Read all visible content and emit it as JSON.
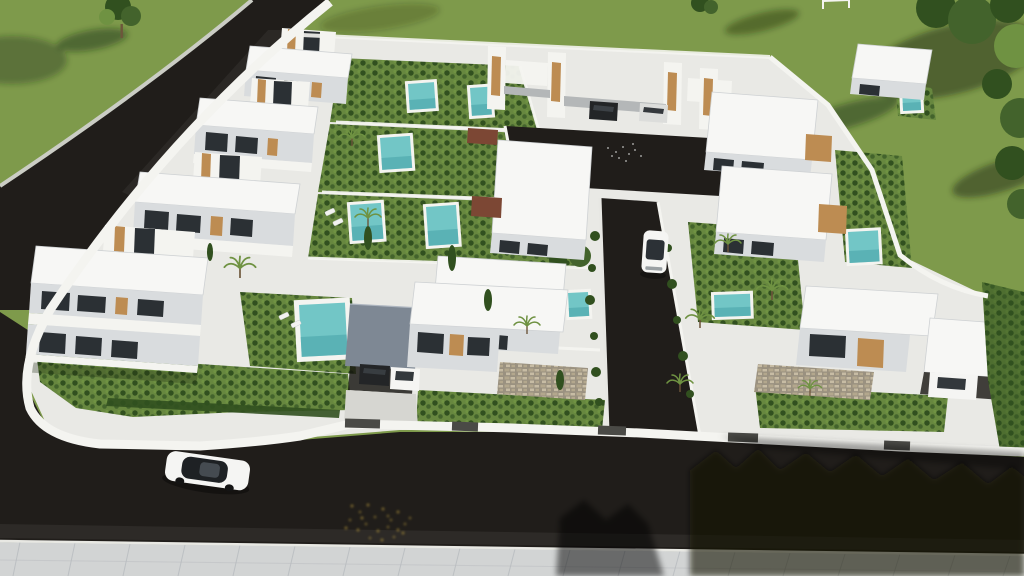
{
  "meta": {
    "type": "aerial-3d-architectural-render",
    "subject": "Aerial 3D rendering of a modern white villa development with private pools, asphalt streets, landscaped gardens and lawns",
    "no_visible_text": true
  },
  "palette": {
    "grass": "#7e9a4b",
    "lawn_shadow": "#1d2a10",
    "road": "#201d1a",
    "pavement": "#d2d4d4",
    "pavement_line": "#b9bcc0",
    "concrete": "#e9e9e5",
    "wall": "#f4f4f0",
    "face": "#d9dcde",
    "roof": "#f7f7f5",
    "roof_edge": "#ced1d3",
    "roof_gray": "#7e8894",
    "wood": "#bd8c52",
    "terracotta": "#7c4734",
    "glass": "#2b3034",
    "pool": "#72c6c6",
    "pool_deep": "#47a2a7",
    "garden": "#67873f",
    "tree_dark": "#31501f",
    "shrub": "#43632c",
    "palm_green": "#6f9242",
    "trunk": "#6d563b",
    "car_white": "#f5f5f3",
    "car_silver": "#dcdddb",
    "car_dark": "#232527",
    "gold": "#bd9d3e",
    "gate": "#4a4a46",
    "stone_bg": "#9a9180",
    "stone_a": "#b3a78d",
    "stone_b": "#c7bca4"
  },
  "scene": {
    "lawns": [
      "upper-left lawn with single tree",
      "large upper-right lawn with tree cluster and long shadows"
    ],
    "streets": {
      "left_street": "diagonal asphalt road along upper-left edge",
      "front_street": "wide asphalt road along the bottom",
      "sidewalk": "light paved sidewalk along bottom edge",
      "internal_driveway": "private lane from central courtyard to front street"
    },
    "block": {
      "villas": 11,
      "carport_duplex_units": 2,
      "pools": 10,
      "boundary": "white perimeter wall with dark gate segments",
      "corner": "rounded white wall at lower-left corner"
    },
    "vehicles": [
      {
        "name": "white-suv",
        "location": "driving on front street"
      },
      {
        "name": "white-hatchback",
        "location": "internal driveway"
      },
      {
        "name": "dark-car",
        "location": "courtyard carport"
      },
      {
        "name": "silver-car",
        "location": "courtyard carport"
      },
      {
        "name": "dark-car",
        "location": "front villa carport"
      },
      {
        "name": "white-car",
        "location": "front villa carport"
      },
      {
        "name": "white-car",
        "location": "right villa carport"
      }
    ],
    "details": [
      "scattered yellow leaves on asphalt near bottom center",
      "tree shadows cast across road at bottom right",
      "sun loungers beside pools",
      "wood-slat facade accents on villas"
    ]
  }
}
